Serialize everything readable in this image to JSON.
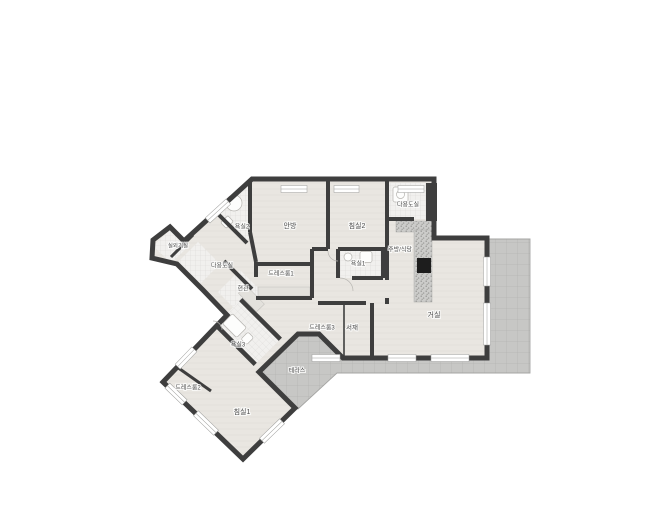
{
  "plan": {
    "type": "apartment-floor-plan",
    "language": "ko"
  },
  "colors": {
    "background": "#ffffff",
    "wall": "#3e3e3e",
    "floor": "#e9e6e1",
    "tile": "#f1f0ee",
    "terrace": "#c7c7c5",
    "terrace_line": "#b4b4b2",
    "counter": "#ccccca",
    "island": "#1d1d1d",
    "label_text": "#4a4a4a"
  },
  "rooms": [
    {
      "id": "master-bedroom",
      "label": "안방",
      "x": 290,
      "y": 226,
      "fs": 7
    },
    {
      "id": "bedroom2",
      "label": "침실2",
      "x": 357,
      "y": 226,
      "fs": 7
    },
    {
      "id": "utility-top",
      "label": "다용도실",
      "x": 408,
      "y": 205,
      "fs": 6
    },
    {
      "id": "kitchen-dining",
      "label": "주방/식당",
      "x": 400,
      "y": 250,
      "fs": 6
    },
    {
      "id": "living-room",
      "label": "거실",
      "x": 434,
      "y": 315,
      "fs": 7
    },
    {
      "id": "bathroom1",
      "label": "욕실1",
      "x": 358,
      "y": 264,
      "fs": 6
    },
    {
      "id": "dressroom1",
      "label": "드레스룸1",
      "x": 281,
      "y": 274,
      "fs": 6
    },
    {
      "id": "entrance",
      "label": "현관",
      "x": 243,
      "y": 289,
      "fs": 6
    },
    {
      "id": "utility-left",
      "label": "다용도실",
      "x": 222,
      "y": 266,
      "fs": 6
    },
    {
      "id": "outdoor-unit",
      "label": "실외기실",
      "x": 178,
      "y": 246,
      "fs": 5.5
    },
    {
      "id": "bathroom2",
      "label": "욕실2",
      "x": 242,
      "y": 227,
      "fs": 6
    },
    {
      "id": "dressroom3",
      "label": "드레스룸3",
      "x": 322,
      "y": 328,
      "fs": 6
    },
    {
      "id": "study",
      "label": "서재",
      "x": 352,
      "y": 328,
      "fs": 6.5
    },
    {
      "id": "bathroom3",
      "label": "욕실3",
      "x": 238,
      "y": 345,
      "fs": 6
    },
    {
      "id": "dressroom2",
      "label": "드레스룸2",
      "x": 188,
      "y": 388,
      "fs": 6
    },
    {
      "id": "bedroom1",
      "label": "침실1",
      "x": 242,
      "y": 412,
      "fs": 7
    },
    {
      "id": "terrace",
      "label": "테라스",
      "x": 297,
      "y": 371,
      "fs": 6
    }
  ]
}
